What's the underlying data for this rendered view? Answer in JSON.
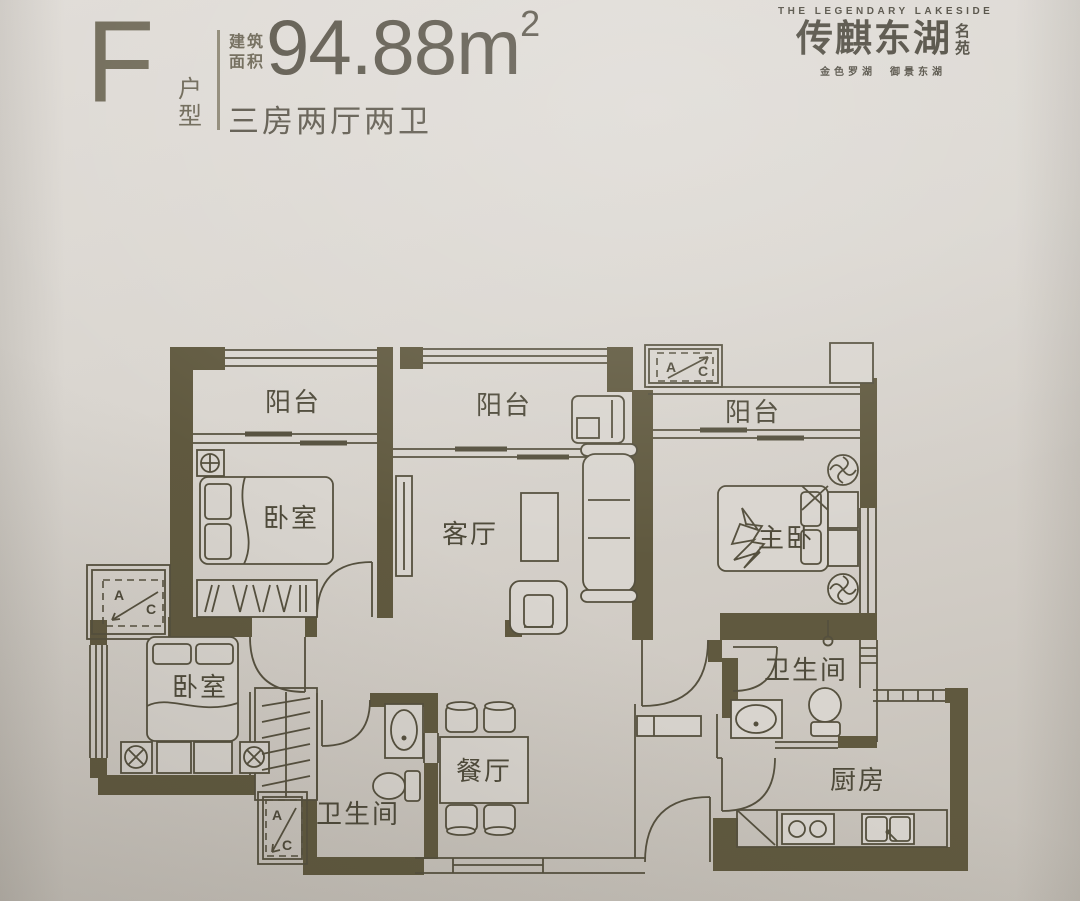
{
  "header": {
    "unit_letter": "F",
    "unit_type": "户型",
    "area_label": [
      "建筑",
      "面积"
    ],
    "area_value": "94.88m",
    "area_sup": "2",
    "layout": "三房两厅两卫"
  },
  "logo": {
    "tagline": "THE LEGENDARY LAKESIDE",
    "name": "传麒东湖",
    "suffix": "名苑",
    "subtitle": "金色罗湖　御景东湖"
  },
  "plan": {
    "colors": {
      "paper": "#d9d5cf",
      "wall": "#60593f",
      "line": "#55503e",
      "text": "#4e4a3a"
    },
    "rooms": {
      "balcony1": "阳台",
      "balcony2": "阳台",
      "balcony3": "阳台",
      "bedroom1": "卧室",
      "bedroom2": "卧室",
      "master": "主卧",
      "living": "客厅",
      "dining": "餐厅",
      "kitchen": "厨房",
      "bath1": "卫生间",
      "bath2": "卫生间"
    },
    "ac": {
      "a": "A",
      "c": "C"
    }
  }
}
